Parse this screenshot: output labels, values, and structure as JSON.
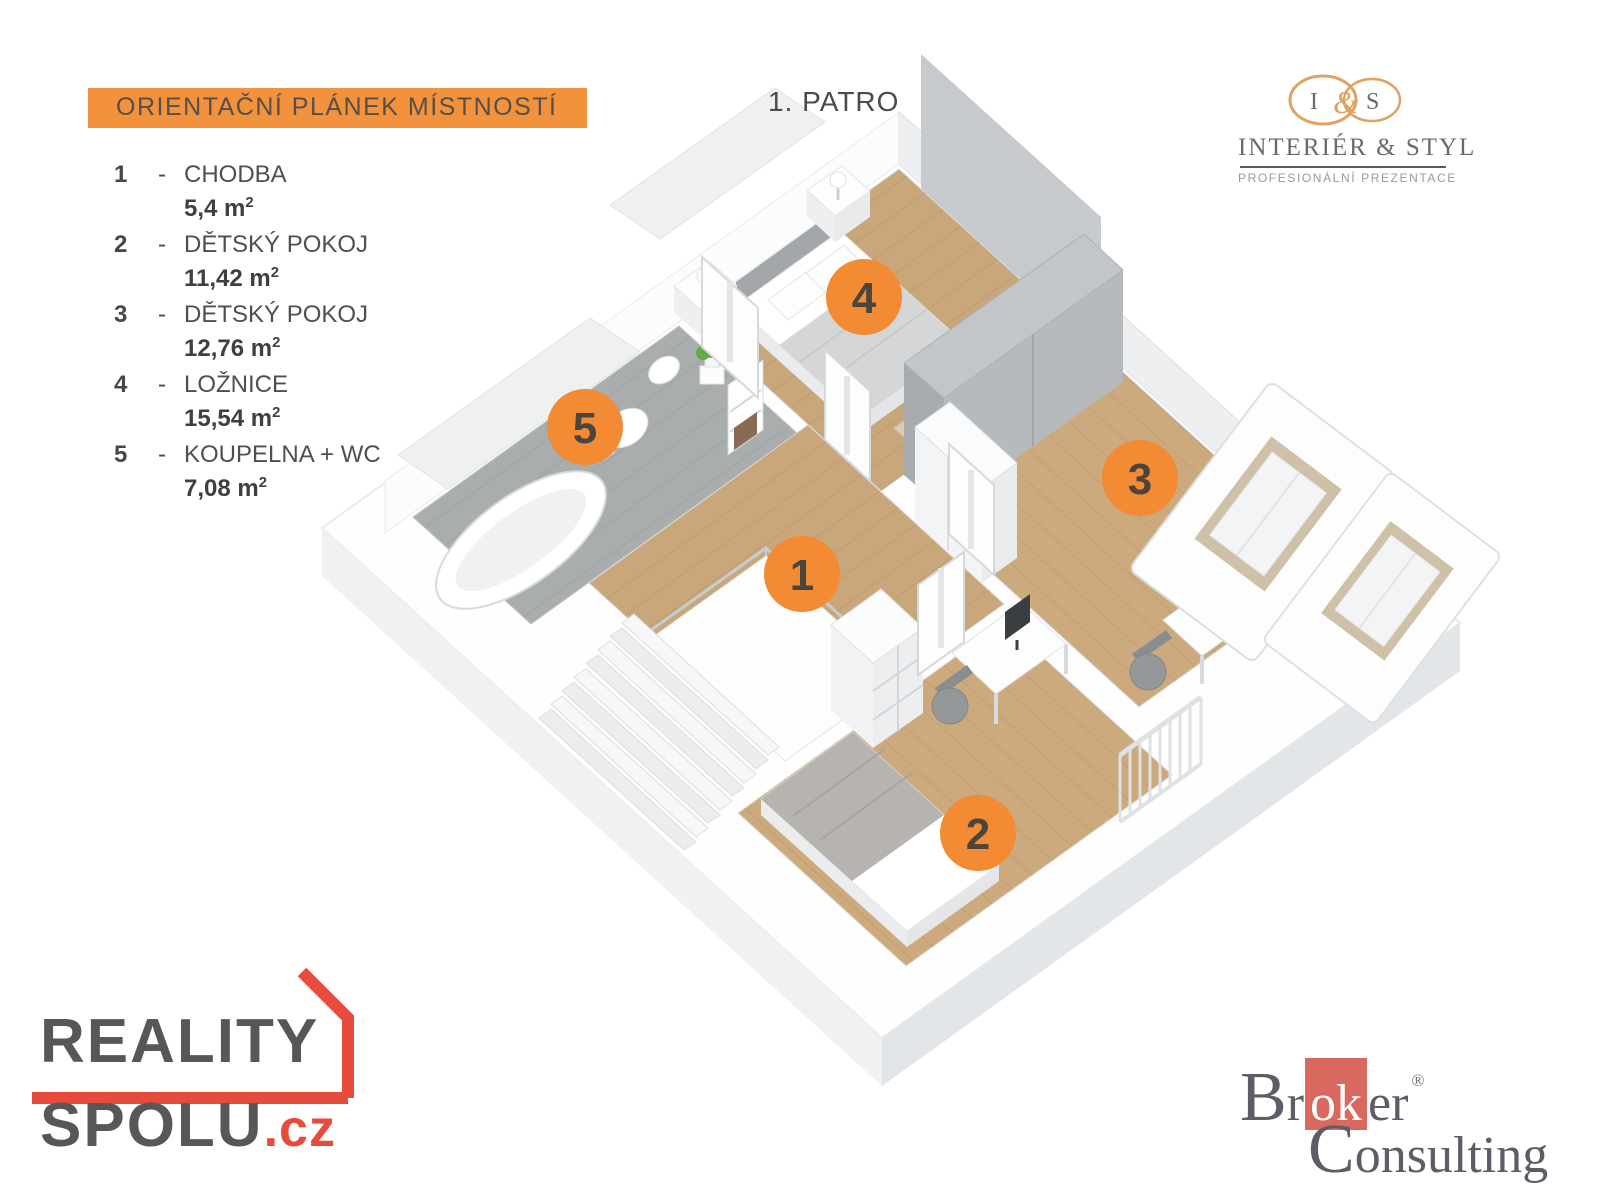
{
  "legend": {
    "title": "ORIENTAČNÍ PLÁNEK MÍSTNOSTÍ",
    "title_bg": "#F2923C",
    "sep": "-",
    "sup": "2",
    "rooms": [
      {
        "id": "1",
        "name": "CHODBA",
        "area": "5,4 m"
      },
      {
        "id": "2",
        "name": "DĚTSKÝ POKOJ",
        "area": "11,42 m"
      },
      {
        "id": "3",
        "name": "DĚTSKÝ POKOJ",
        "area": "12,76 m"
      },
      {
        "id": "4",
        "name": "LOŽNICE",
        "area": "15,54 m"
      },
      {
        "id": "5",
        "name": "KOUPELNA + WC",
        "area": "7,08 m"
      }
    ]
  },
  "plan": {
    "floor_label": "1. PATRO",
    "badge_color": "#F28B33",
    "wood_color": "#C9A77B",
    "tile_color": "#A9ADAE"
  },
  "branding": {
    "interier_styl": {
      "monogram_i": "I",
      "monogram_amp": "&",
      "monogram_s": "S",
      "line1": "INTERIÉR & STYL",
      "line2": "PROFESIONÁLNÍ PREZENTACE",
      "accent": "#DFA263"
    },
    "reality_spolu": {
      "word1": "REALITY",
      "word2": "SPOLU",
      "tld": ".cz",
      "accent": "#E84A3C"
    },
    "broker_consulting": {
      "part_br": "Br",
      "part_ok": "ok",
      "part_er": "er",
      "reg": "®",
      "line2": "Consulting",
      "accent": "#D9685E"
    }
  }
}
